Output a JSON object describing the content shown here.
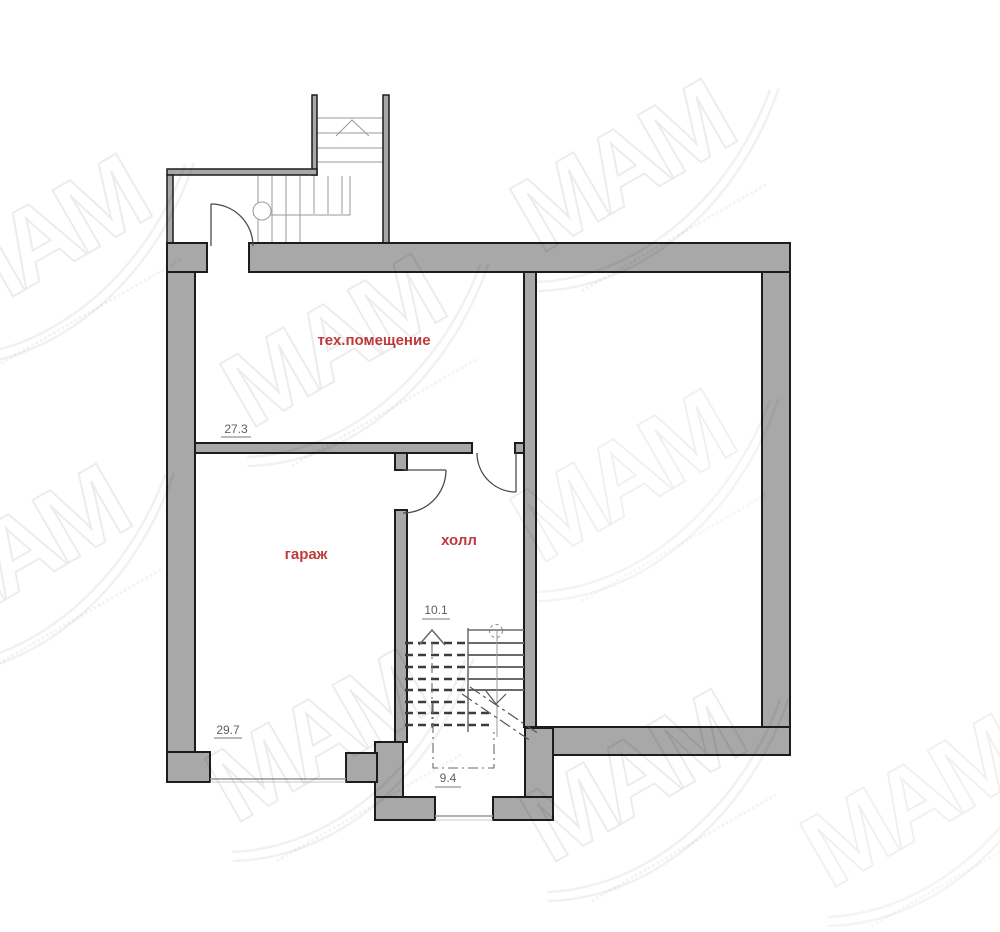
{
  "rooms": [
    {
      "label": "тех.помещение",
      "area": "27.3"
    },
    {
      "label": "гараж",
      "area": "29.7"
    },
    {
      "label": "холл",
      "area": "10.1"
    },
    {
      "label": "",
      "area": "9.4"
    }
  ],
  "watermark": {
    "text": "МАМ"
  },
  "colors": {
    "wall_fill": "#a8a8a8",
    "wall_outline": "#1c1c1c",
    "room_label": "#bf3a3a",
    "area_text": "#5f5f5f"
  }
}
